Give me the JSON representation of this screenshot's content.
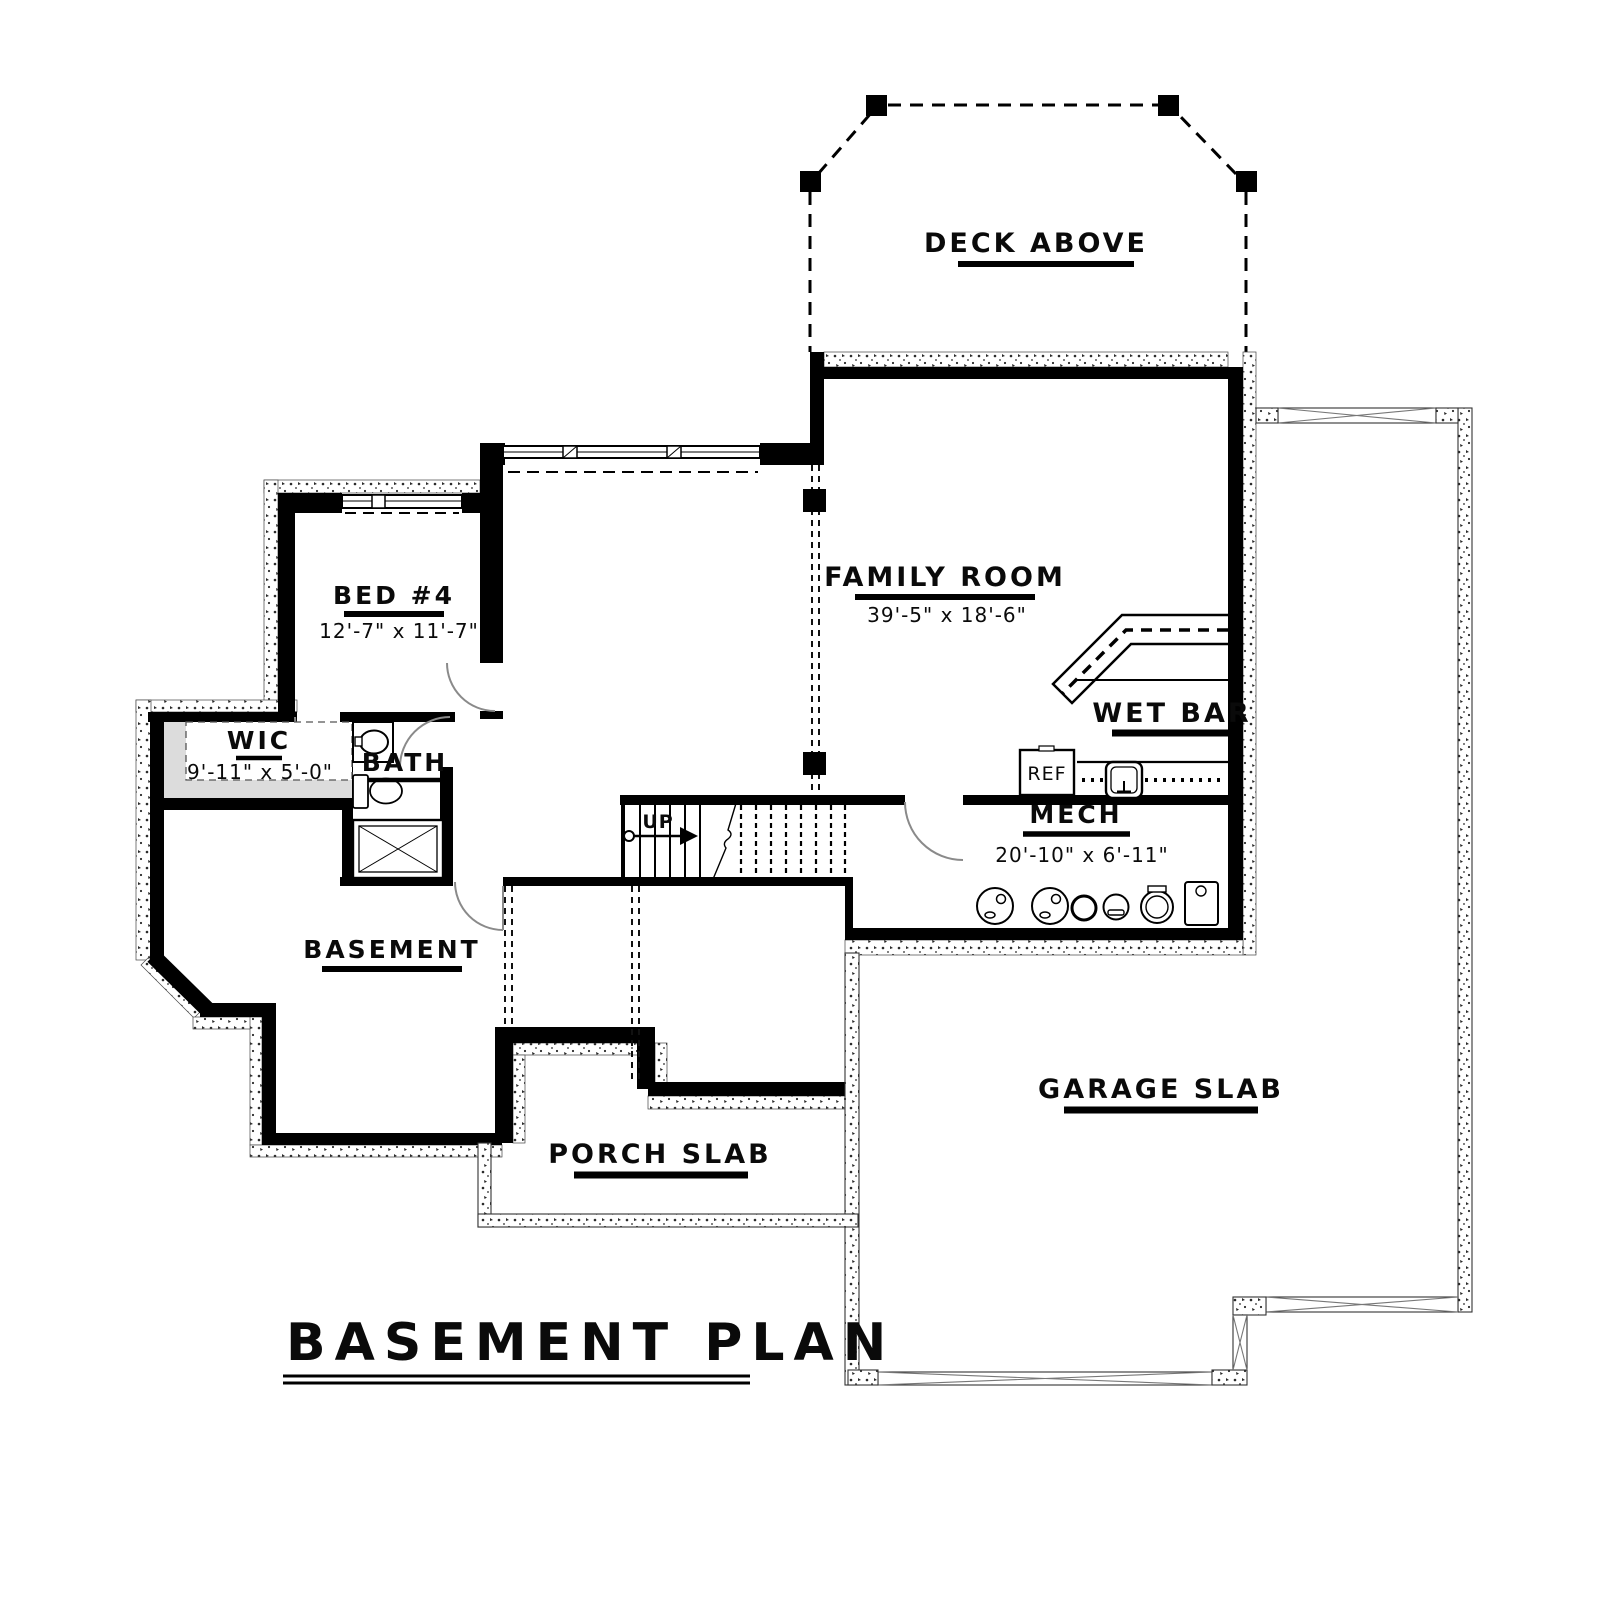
{
  "title": "BASEMENT PLAN",
  "rooms": {
    "deck": {
      "label": "DECK ABOVE"
    },
    "family": {
      "label": "FAMILY ROOM",
      "dims": "39'-5\" x 18'-6\""
    },
    "bed4": {
      "label": "BED #4",
      "dims": "12'-7\" x 11'-7\""
    },
    "wic": {
      "label": "WIC",
      "dims": "9'-11\" x 5'-0\""
    },
    "bath": {
      "label": "BATH"
    },
    "wetbar": {
      "label": "WET BAR"
    },
    "mech": {
      "label": "MECH",
      "dims": "20'-10\" x 6'-11\""
    },
    "basement": {
      "label": "BASEMENT"
    },
    "porch": {
      "label": "PORCH SLAB"
    },
    "garage": {
      "label": "GARAGE SLAB"
    }
  },
  "annotations": {
    "stairs_up": "UP",
    "fridge": "REF"
  },
  "colors": {
    "wall": "#000000",
    "line": "#1a1a1a",
    "door": "#8a8a8a",
    "stipple": "#2a2a2a",
    "wic_shade": "#dcdcdc",
    "background": "#ffffff"
  }
}
